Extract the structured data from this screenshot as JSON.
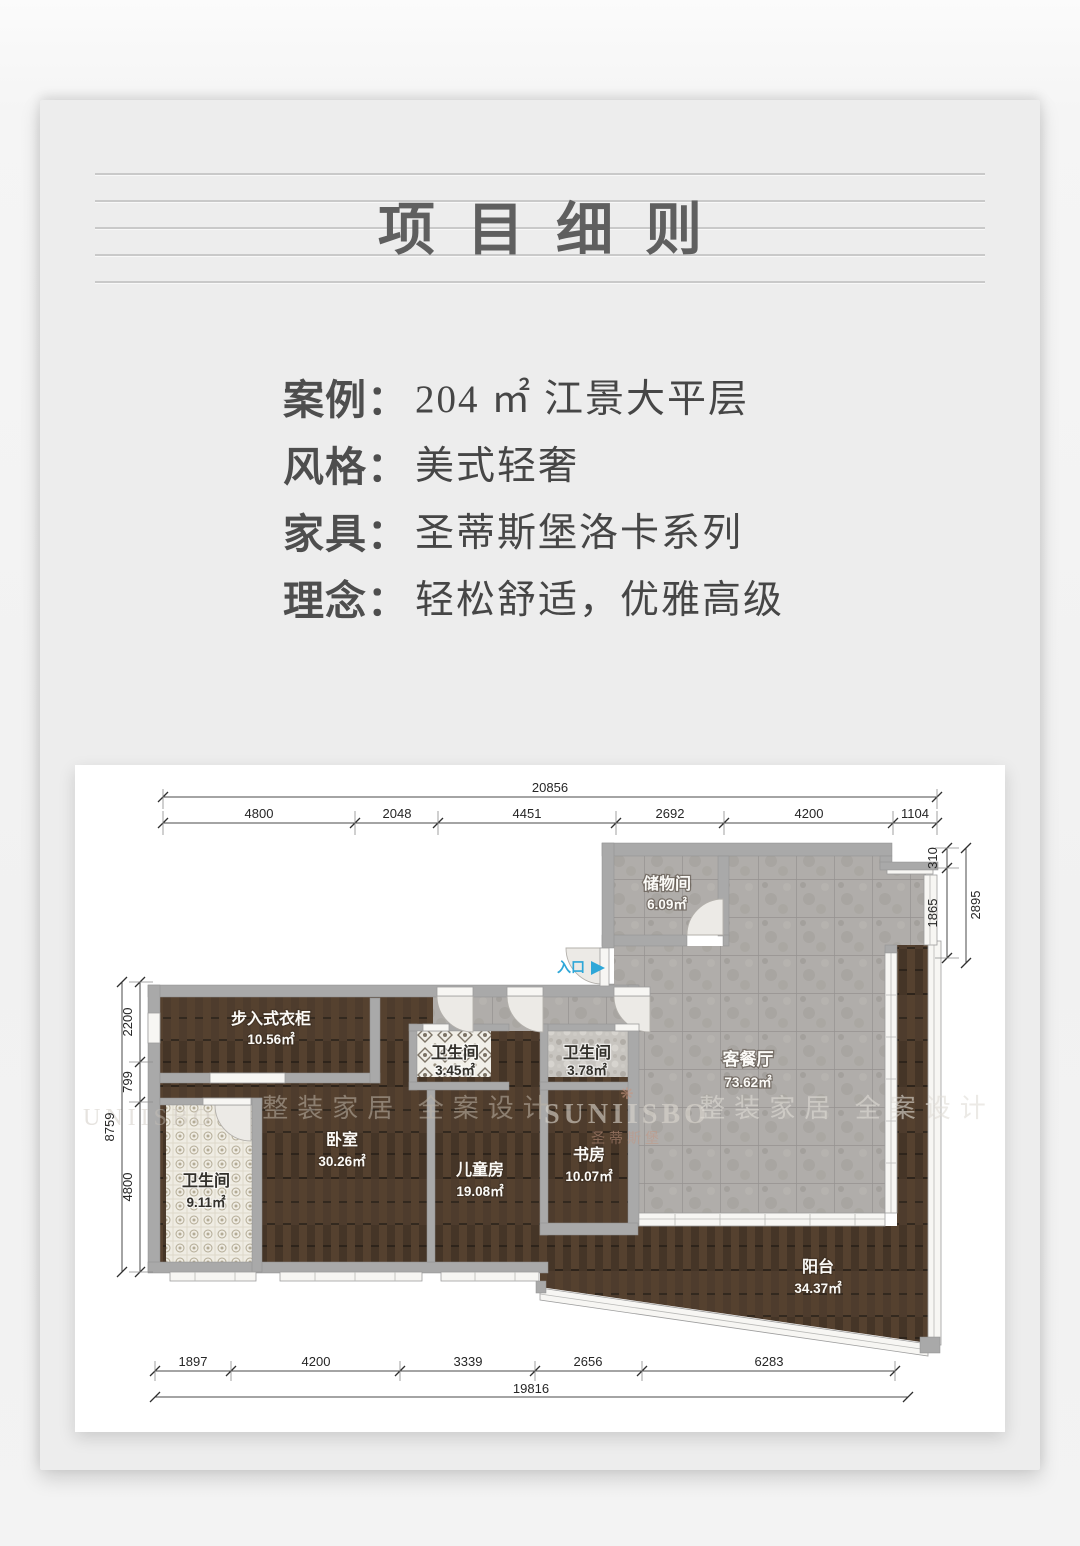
{
  "page": {
    "title": "项目细则"
  },
  "ui": {
    "colon": "："
  },
  "details": [
    {
      "label": "案例",
      "value": "204 ㎡ 江景大平层"
    },
    {
      "label": "风格",
      "value": "美式轻奢"
    },
    {
      "label": "家具",
      "value": "圣蒂斯堡洛卡系列"
    },
    {
      "label": "理念",
      "value": "轻松舒适，优雅高级"
    }
  ],
  "floorplan": {
    "entrance_label": "入口",
    "rooms": [
      {
        "name": "储物间",
        "area": "6.09㎡"
      },
      {
        "name": "客餐厅",
        "area": "73.62㎡"
      },
      {
        "name": "步入式衣柜",
        "area": "10.56㎡"
      },
      {
        "name": "卫生间",
        "area": "3.45㎡"
      },
      {
        "name": "卫生间",
        "area": "3.78㎡"
      },
      {
        "name": "卧室",
        "area": "30.26㎡"
      },
      {
        "name": "儿童房",
        "area": "19.08㎡"
      },
      {
        "name": "书房",
        "area": "10.07㎡"
      },
      {
        "name": "卫生间",
        "area": "9.11㎡"
      },
      {
        "name": "阳台",
        "area": "34.37㎡"
      }
    ],
    "dimensions": {
      "top_total": "20856",
      "top_segments": [
        "4800",
        "2048",
        "4451",
        "2692",
        "4200",
        "1104"
      ],
      "right_segments": [
        "310",
        "1865"
      ],
      "right_total": "2895",
      "left_segments": [
        "2200",
        "799",
        "4800"
      ],
      "left_total": "8759",
      "bottom_segments": [
        "1897",
        "4200",
        "3339",
        "2656",
        "6283"
      ],
      "bottom_total": "19816"
    },
    "watermarks": {
      "left_partial": "UNIISBO",
      "left": "整装家居 全案设计",
      "brand": "SUNIISBO",
      "brand_sub": "圣蒂斯堡",
      "flower_icon": "❋",
      "right": "整装家居 全案设计"
    }
  },
  "colors": {
    "accent_blue": "#2ea7d8",
    "wall_gray": "#a9a9a9",
    "wood_brown": "#4c3b2e",
    "tile_gray": "#aeaba7",
    "card_gray": "#ededed"
  }
}
